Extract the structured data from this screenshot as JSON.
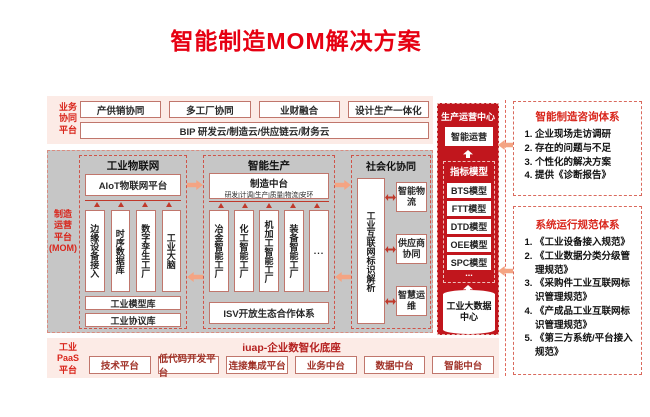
{
  "title": "智能制造MOM解决方案",
  "business_band": {
    "label": "业务\n协同\n平台",
    "items": [
      "产供销协同",
      "多工厂协同",
      "业财融合",
      "设计生产一体化"
    ],
    "bip_label": "BIP 研发云/制造云/供应链云/财务云"
  },
  "mom": {
    "label": "制造\n运营\n平台\n(MOM)",
    "iot": {
      "title": "工业物联网",
      "platform": "AIoT物联网平台",
      "pillars": [
        "边缘设备接入",
        "时序数据库",
        "数字孪生工厂",
        "工业大脑"
      ],
      "libraries": [
        "工业模型库",
        "工业协议库"
      ]
    },
    "production": {
      "title": "智能生产",
      "hub_title": "制造中台",
      "hub_subtitle": "研发|计调|生产|质量|物流|安环",
      "pillars": [
        "冶金智能工厂",
        "化工智能工厂",
        "机加工智能工厂",
        "装备智能工厂",
        "..."
      ],
      "isv_label": "ISV开放生态合作体系"
    },
    "social": {
      "title": "社会化协同",
      "resolver": "工业互联网标识解析",
      "items": [
        "智能物流",
        "供应商协同",
        "智慧运维"
      ]
    }
  },
  "ops_center": {
    "title": "生产运营中心",
    "smart_ops": "智能运营",
    "metrics_title": "指标模型",
    "models": [
      "BTS模型",
      "FTT模型",
      "DTD模型",
      "OEE模型",
      "SPC模型"
    ],
    "ellipsis": "...",
    "data_center": "工业大数据中心"
  },
  "right_panel": {
    "consulting": {
      "title": "智能制造咨询体系",
      "items": [
        "企业现场走访调研",
        "存在的问题与不足",
        "个性化的解决方案",
        "提供《诊断报告》"
      ]
    },
    "standards": {
      "title": "系统运行规范体系",
      "items": [
        "《工业设备接入规范》",
        "《工业数据分类分级管理规范》",
        "《采购件工业互联网标识管理规范》",
        "《产成品工业互联网标识管理规范》",
        "《第三方系统/平台接入规范》"
      ]
    }
  },
  "paas_band": {
    "label": "工业\nPaaS\n平台",
    "title": "iuap-企业数智化底座",
    "items": [
      "技术平台",
      "低代码开发平台",
      "连接集成平台",
      "业务中台",
      "数据中台",
      "智能中台"
    ]
  },
  "colors": {
    "title_red": "#e60012",
    "column_red": "#c1161d",
    "band_pink": "#fcebe6",
    "mom_gray": "#c6c6c6",
    "arrow_orange": "#f4a483",
    "box_border": "#c0766c"
  }
}
